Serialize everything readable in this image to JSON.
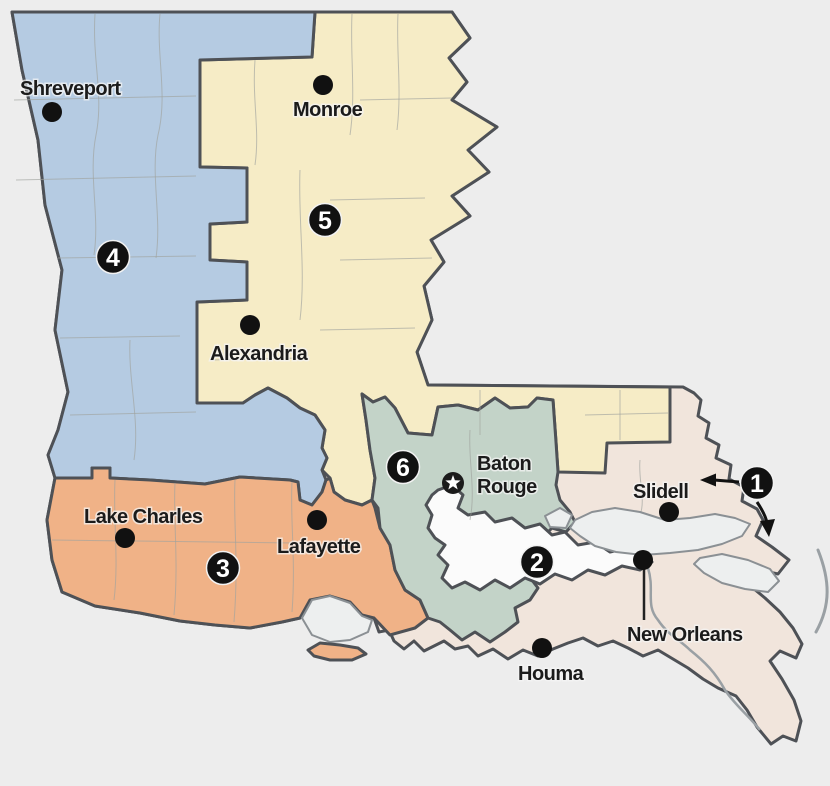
{
  "map_name": "Louisiana congressional districts map",
  "colors": {
    "background": "#ededed",
    "water": "#edefef",
    "district_border": "#4e5156",
    "coastline": "#8b9094",
    "parish_line": "#a0a39e",
    "marker": "#111111"
  },
  "districts": [
    {
      "number": "1",
      "color": "#f1e5dc"
    },
    {
      "number": "2",
      "color": "#fbfbfb"
    },
    {
      "number": "3",
      "color": "#f0b287"
    },
    {
      "number": "4",
      "color": "#b5cbe2"
    },
    {
      "number": "5",
      "color": "#f6ecc6"
    },
    {
      "number": "6",
      "color": "#c3d3c8"
    }
  ],
  "cities": [
    {
      "name": "Shreveport"
    },
    {
      "name": "Monroe"
    },
    {
      "name": "Alexandria"
    },
    {
      "name": "Lake Charles"
    },
    {
      "name": "Lafayette"
    },
    {
      "name": "Slidell"
    },
    {
      "name": "New Orleans"
    },
    {
      "name": "Houma"
    }
  ],
  "capital": {
    "name": "Baton Rouge",
    "line1": "Baton",
    "line2": "Rouge"
  }
}
